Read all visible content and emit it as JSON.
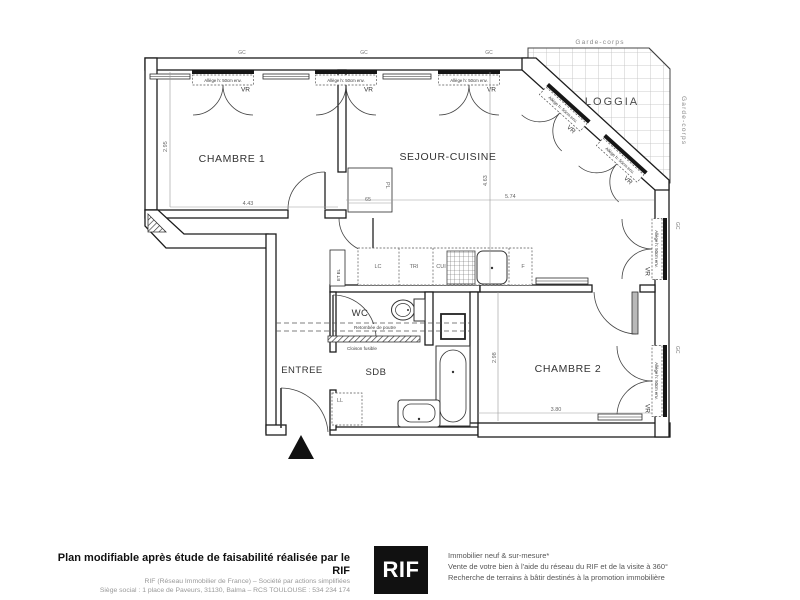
{
  "plan": {
    "rooms": {
      "chambre1": "CHAMBRE 1",
      "sejour": "SEJOUR-CUISINE",
      "loggia": "LOGGIA",
      "chambre2": "CHAMBRE 2",
      "wc": "WC",
      "sdb": "SDB",
      "entree": "ENTREE"
    },
    "labels": {
      "vr": "VR",
      "allege": "Allège h: 50cm env.",
      "gc": "GC",
      "garde_corps": "Garde-corps",
      "pl": "PL",
      "ll": "LL",
      "lc": "LC",
      "tri": "TRI",
      "cui": "CUI",
      "f": "F",
      "et_el": "ET EL",
      "retombee": "Retombée de poutre",
      "cloison": "Cloison fusible"
    },
    "dimensions": {
      "chambre1_width": "4.43",
      "chambre1_depth": "2.95",
      "closet_width": "65",
      "sejour_width": "5.74",
      "sejour_depth": "4.63",
      "chambre2_depth": "2.98",
      "chambre2_width": "3.80"
    }
  },
  "footer": {
    "title": "Plan modifiable après étude de faisabilité réalisée par le RIF",
    "company_line": "RIF (Réseau Immobilier de France) – Société par actions simplifiées",
    "address_line": "Siège social : 1 place de Paveurs, 31130, Balma – RCS TOULOUSE : 534 234 174",
    "logo": "RIF",
    "service1": "Immobilier neuf & sur-mesure*",
    "service2": "Vente de votre bien à l'aide du réseau du RIF et de la visite à 360°",
    "service3": "Recherche de terrains à bâtir destinés à la promotion immobilière"
  }
}
